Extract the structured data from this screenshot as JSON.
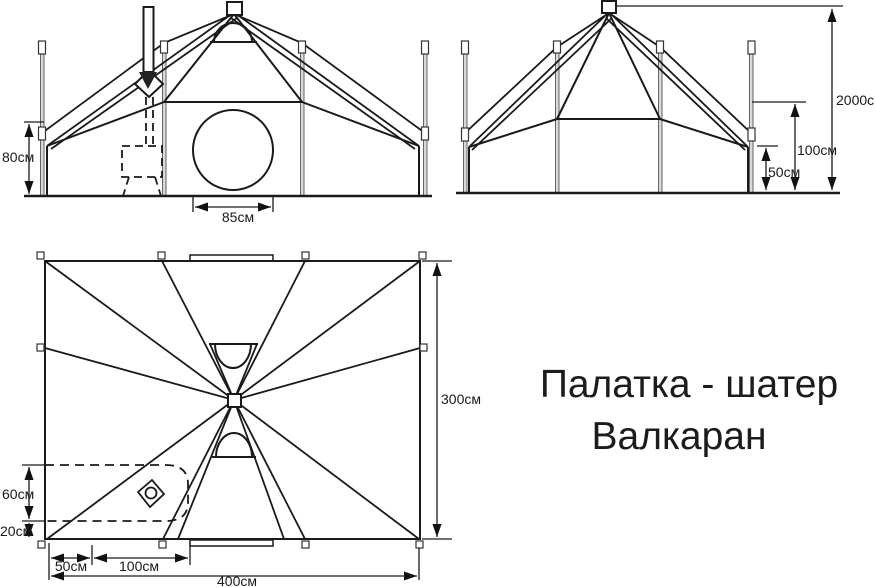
{
  "title": {
    "line1": "Палатка - шатер",
    "line2": "Валкаран"
  },
  "front_view": {
    "wall_height": "80см",
    "window_diameter": "85см"
  },
  "side_view": {
    "total_height": "2000см",
    "eave_height": "100см",
    "corner_height": "50см"
  },
  "plan_view": {
    "length": "400см",
    "width": "300см",
    "stove_zone_depth": "60см",
    "stove_zone_margin": "20см",
    "stove_offset": "50см",
    "stove_zone_length": "100см"
  },
  "colors": {
    "line": "#1a1a1a",
    "pole_fill": "#d9d9d9",
    "background": "#ffffff"
  }
}
